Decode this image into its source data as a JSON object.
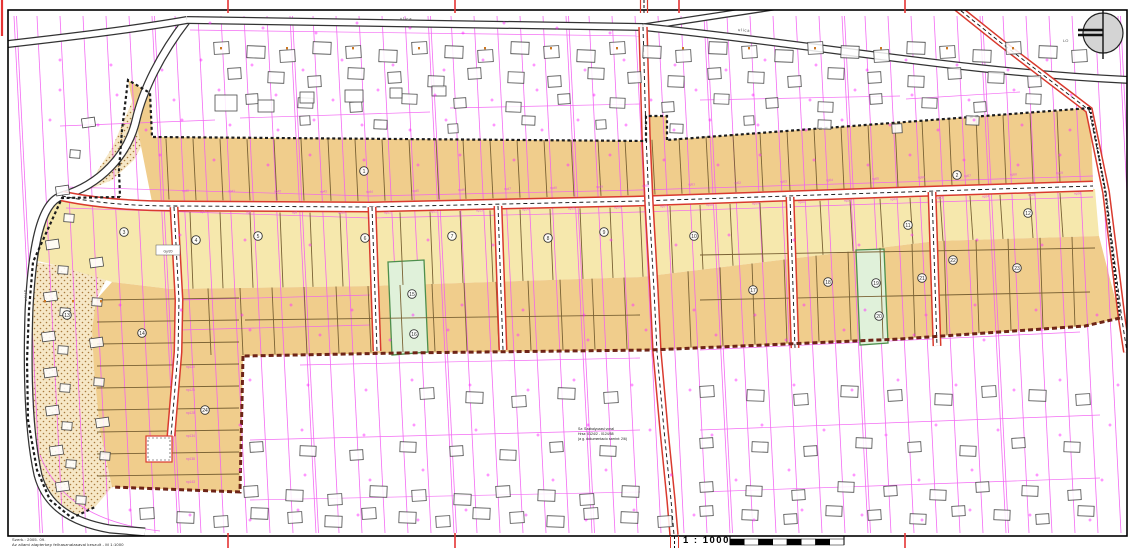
{
  "footer": {
    "scale_label": "1 : 1000",
    "left_line1": "Szerk.: 2005. 09.",
    "left_line2": "Az allami alapterkep felhasznalasaval keszult - M 1:1000"
  },
  "annotation": {
    "lines": [
      "Sz: Szabalyozasi vonal",
      "Hrsz: 0124/2 - 0124/58",
      "(a g. dokumentacio szerint: 2/6)"
    ]
  },
  "colors": {
    "magenta": "#f25cf2",
    "magenta2": "#ff2fff",
    "tan": "#f0cd8c",
    "light": "#f6e8ad",
    "stipple_bg": "#f6e7c6",
    "stipple_dot": "#a97b3e",
    "green_fill": "#e0f1da",
    "green_stroke": "#4d8f4d",
    "road_red": "#d93a2e",
    "road_black": "#333333",
    "maroon": "#6e2417",
    "boundary": "#1c1c1c",
    "divider": "#7a6234",
    "building": "#4a4a4a",
    "marker": "#333333",
    "np": "#e34fe3",
    "orange": "#cc7722",
    "tick_red": "#e53333",
    "text": "#222222"
  },
  "canvas": {
    "w": 1129,
    "h": 548
  },
  "frame": {
    "x": 8,
    "y": 10,
    "w": 1119,
    "h": 526
  },
  "red_ticks": {
    "top": [
      228,
      455,
      679,
      905
    ],
    "bottom": [
      228,
      455,
      905
    ],
    "left_edge_x": 2
  },
  "compass": {
    "cx": 1103,
    "cy": 33,
    "r": 20,
    "label": "LO"
  },
  "scalebar": {
    "x": 730,
    "y": 539,
    "w": 114,
    "h": 6,
    "segments": 8
  },
  "zones": {
    "upper_tan": [
      [
        128,
        80
      ],
      [
        150,
        93
      ],
      [
        152,
        137
      ],
      [
        646,
        141
      ],
      [
        646,
        116
      ],
      [
        667,
        116
      ],
      [
        667,
        140
      ],
      [
        1090,
        108
      ],
      [
        1093,
        182
      ],
      [
        935,
        188
      ],
      [
        640,
        198
      ],
      [
        370,
        204
      ],
      [
        152,
        202
      ]
    ],
    "light_strip": [
      [
        62,
        198
      ],
      [
        175,
        211
      ],
      [
        370,
        212
      ],
      [
        640,
        206
      ],
      [
        935,
        196
      ],
      [
        1095,
        189
      ],
      [
        1099,
        236
      ],
      [
        936,
        241
      ],
      [
        641,
        277
      ],
      [
        371,
        286
      ],
      [
        171,
        289
      ],
      [
        112,
        282
      ],
      [
        60,
        266
      ],
      [
        33,
        260
      ],
      [
        37,
        232
      ],
      [
        48,
        208
      ]
    ],
    "tan_lower": [
      [
        112,
        282
      ],
      [
        171,
        289
      ],
      [
        371,
        286
      ],
      [
        641,
        277
      ],
      [
        936,
        241
      ],
      [
        1099,
        236
      ],
      [
        1120,
        318
      ],
      [
        1085,
        326
      ],
      [
        900,
        339
      ],
      [
        650,
        350
      ],
      [
        400,
        353
      ],
      [
        243,
        356
      ],
      [
        240,
        492
      ],
      [
        112,
        487
      ],
      [
        100,
        430
      ],
      [
        94,
        370
      ],
      [
        92,
        330
      ],
      [
        96,
        300
      ]
    ],
    "stipple_upper": [
      [
        140,
        90
      ],
      [
        150,
        97
      ],
      [
        150,
        130
      ],
      [
        134,
        160
      ],
      [
        112,
        180
      ],
      [
        88,
        190
      ],
      [
        98,
        170
      ],
      [
        112,
        148
      ],
      [
        124,
        120
      ],
      [
        132,
        102
      ]
    ],
    "stipple_lower": [
      [
        33,
        262
      ],
      [
        110,
        272
      ],
      [
        96,
        300
      ],
      [
        92,
        330
      ],
      [
        94,
        370
      ],
      [
        100,
        430
      ],
      [
        112,
        487
      ],
      [
        95,
        507
      ],
      [
        70,
        518
      ],
      [
        50,
        500
      ],
      [
        37,
        470
      ],
      [
        28,
        420
      ],
      [
        27,
        360
      ],
      [
        29,
        310
      ]
    ],
    "green1": [
      [
        388,
        262
      ],
      [
        424,
        260
      ],
      [
        428,
        352
      ],
      [
        392,
        355
      ]
    ],
    "green2": [
      [
        856,
        250
      ],
      [
        884,
        249
      ],
      [
        888,
        343
      ],
      [
        860,
        345
      ]
    ]
  },
  "edges": {
    "tb": [
      [
        152,
        139
      ],
      [
        646,
        140
      ],
      [
        667,
        139
      ],
      [
        1090,
        109
      ]
    ],
    "road_top": [
      [
        62,
        191
      ],
      [
        175,
        200
      ],
      [
        370,
        201
      ],
      [
        640,
        195
      ],
      [
        935,
        186
      ],
      [
        1093,
        181
      ]
    ],
    "road_bot": [
      [
        62,
        203
      ],
      [
        175,
        212
      ],
      [
        370,
        213
      ],
      [
        640,
        207
      ],
      [
        935,
        197
      ],
      [
        1093,
        192
      ]
    ],
    "lb": [
      [
        171,
        289
      ],
      [
        371,
        286
      ],
      [
        641,
        277
      ],
      [
        936,
        241
      ],
      [
        1099,
        236
      ]
    ],
    "bb": [
      [
        243,
        355
      ],
      [
        400,
        352
      ],
      [
        650,
        349
      ],
      [
        900,
        338
      ],
      [
        1085,
        326
      ]
    ]
  },
  "boundaries": {
    "black_dashed": [
      [
        [
          1090,
          108
        ],
        [
          667,
          140
        ]
      ],
      [
        [
          667,
          140
        ],
        [
          667,
          116
        ],
        [
          646,
          116
        ],
        [
          646,
          141
        ],
        [
          152,
          137
        ],
        [
          150,
          93
        ],
        [
          128,
          80
        ],
        [
          122,
          130
        ],
        [
          119,
          170
        ],
        [
          120,
          197
        ]
      ],
      [
        [
          120,
          197
        ],
        [
          62,
          198
        ],
        [
          33,
          262
        ],
        [
          29,
          310
        ],
        [
          27,
          360
        ],
        [
          28,
          420
        ],
        [
          37,
          470
        ],
        [
          50,
          500
        ],
        [
          72,
          518
        ],
        [
          95,
          507
        ]
      ]
    ],
    "black_dotted_right": [
      [
        1090,
        108
      ],
      [
        1105,
        190
      ],
      [
        1120,
        318
      ]
    ],
    "maroon": [
      [
        [
          1120,
          318
        ],
        [
          1085,
          326
        ],
        [
          900,
          339
        ],
        [
          650,
          350
        ],
        [
          400,
          353
        ],
        [
          243,
          356
        ]
      ],
      [
        [
          243,
          356
        ],
        [
          240,
          492
        ],
        [
          112,
          487
        ]
      ]
    ]
  },
  "roads": [
    {
      "name": "left-street",
      "d": "M 187,20 C 160,55 143,90 136,120 C 128,155 100,185 62,196 C 40,202 32,250 29,310 C 27,370 28,430 38,475 C 46,505 70,522 110,529 L 145,532",
      "style": "black",
      "ew": 9,
      "fw": 6.5
    },
    {
      "name": "top-road-west",
      "d": "M 8,44 C 60,38 130,30 187,20",
      "style": "black",
      "ew": 8,
      "fw": 5.5
    },
    {
      "name": "top-road-mid",
      "d": "M 187,20 L 643,27",
      "style": "black",
      "ew": 8,
      "fw": 5.5
    },
    {
      "name": "top-road-ne",
      "d": "M 643,27 L 800,3",
      "style": "black",
      "ew": 7,
      "fw": 4.5
    },
    {
      "name": "top-road-east",
      "d": "M 643,27 C 820,45 960,72 1129,80",
      "style": "black",
      "ew": 8,
      "fw": 5.5
    },
    {
      "name": "main-road",
      "d": "M 62,196 C 100,204 140,206 175,206 L 370,207 L 640,201 L 935,191 L 1093,186",
      "style": "red",
      "ew": 11,
      "fw": 8
    },
    {
      "name": "north-south-road",
      "d": "M 643,27 L 646,135 L 649,203 L 654,290 L 657,352 L 664,430 L 671,500 L 674,535",
      "style": "red",
      "ew": 9.5,
      "fw": 6.5
    },
    {
      "name": "branch-1",
      "d": "M 174,207 L 179,300 L 178,352 L 171,436",
      "style": "red",
      "ew": 9,
      "fw": 6
    },
    {
      "name": "branch-2",
      "d": "M 372,207 L 377,351",
      "style": "red",
      "ew": 9,
      "fw": 6
    },
    {
      "name": "branch-3",
      "d": "M 498,206 L 503,350",
      "style": "red",
      "ew": 9,
      "fw": 6
    },
    {
      "name": "branch-4",
      "d": "M 790,197 L 795,348",
      "style": "red",
      "ew": 9,
      "fw": 6
    },
    {
      "name": "branch-5",
      "d": "M 932,192 L 937,346",
      "style": "red",
      "ew": 9,
      "fw": 6
    },
    {
      "name": "diagonal-road-ne",
      "d": "M 950,2 L 1000,42 L 1089,110 L 1106,192 L 1122,320 L 1127,352",
      "style": "red",
      "ew": 8,
      "fw": 5
    }
  ],
  "culdesac": {
    "x": 146,
    "y": 436,
    "w": 26,
    "h": 26
  },
  "strips": {
    "x0": 14,
    "step": 23,
    "count": 49,
    "y_top": 16,
    "y_bot": 533,
    "lean": 26
  },
  "h_lines": [
    [
      60,
      126,
      215,
      120
    ],
    [
      240,
      118,
      430,
      112
    ],
    [
      450,
      108,
      640,
      104
    ],
    [
      700,
      100,
      900,
      96
    ],
    [
      906,
      99,
      1020,
      92
    ],
    [
      300,
      365,
      640,
      358
    ],
    [
      700,
      350,
      1080,
      332
    ],
    [
      250,
      440,
      640,
      430
    ],
    [
      700,
      430,
      1100,
      415
    ],
    [
      250,
      500,
      640,
      492
    ],
    [
      700,
      492,
      1100,
      478
    ],
    [
      180,
      300,
      370,
      295
    ],
    [
      180,
      330,
      370,
      325
    ]
  ],
  "road_parallel": [
    [
      [
        66,
        187
      ],
      [
        370,
        196
      ],
      [
        640,
        190
      ],
      [
        935,
        181
      ],
      [
        1093,
        176
      ]
    ],
    [
      [
        66,
        208
      ],
      [
        370,
        218
      ],
      [
        640,
        212
      ],
      [
        935,
        202
      ],
      [
        1093,
        197
      ]
    ],
    [
      [
        190,
        30
      ],
      [
        640,
        36
      ]
    ]
  ],
  "bl_curve": "M 40,455 C 58,502 100,524 160,531",
  "divider_bands": [
    {
      "x0": 166,
      "step": 27,
      "count": 34,
      "top": "tb",
      "bot": "road_top"
    },
    {
      "x0": 190,
      "step": 30,
      "count": 30,
      "top": "road_bot",
      "bot": "lb"
    },
    {
      "x0": 208,
      "step": 32,
      "count": 28,
      "top": "lb",
      "bot": "bb"
    }
  ],
  "ext_h": {
    "y0": 300,
    "step": 22,
    "count": 9,
    "x0": 97,
    "x1": 239
  },
  "lower_h": [
    [
      700,
      255,
      1095,
      248
    ],
    [
      700,
      300,
      1090,
      292
    ],
    [
      245,
      320,
      640,
      315
    ]
  ],
  "buildings": {
    "rows": [
      {
        "y": 46,
        "x0": 214,
        "x1": 1078,
        "step": 33,
        "w": 15,
        "h": 12
      },
      {
        "y": 72,
        "x0": 228,
        "x1": 1066,
        "step": 40,
        "w": 13,
        "h": 11
      },
      {
        "y": 98,
        "x0": 246,
        "x1": 1050,
        "step": 52,
        "w": 12,
        "h": 10
      },
      {
        "y": 120,
        "x0": 300,
        "x1": 1000,
        "step": 74,
        "w": 10,
        "h": 9
      },
      {
        "y": 392,
        "x0": 420,
        "x1": 626,
        "step": 46,
        "w": 14,
        "h": 11
      },
      {
        "y": 390,
        "x0": 700,
        "x1": 1096,
        "step": 47,
        "w": 14,
        "h": 11
      },
      {
        "y": 446,
        "x0": 250,
        "x1": 626,
        "step": 50,
        "w": 13,
        "h": 10
      },
      {
        "y": 442,
        "x0": 700,
        "x1": 1104,
        "step": 52,
        "w": 13,
        "h": 10
      },
      {
        "y": 490,
        "x0": 244,
        "x1": 630,
        "step": 42,
        "w": 14,
        "h": 11
      },
      {
        "y": 486,
        "x0": 700,
        "x1": 1100,
        "step": 46,
        "w": 13,
        "h": 10
      },
      {
        "y": 512,
        "x0": 140,
        "x1": 660,
        "step": 37,
        "w": 14,
        "h": 11
      },
      {
        "y": 510,
        "x0": 700,
        "x1": 1094,
        "step": 42,
        "w": 13,
        "h": 10
      }
    ],
    "stipple": [
      [
        82,
        118
      ],
      [
        70,
        150
      ],
      [
        56,
        186
      ],
      [
        64,
        214
      ],
      [
        46,
        240
      ],
      [
        58,
        266
      ],
      [
        44,
        292
      ],
      [
        60,
        308
      ],
      [
        42,
        332
      ],
      [
        58,
        346
      ],
      [
        44,
        368
      ],
      [
        60,
        384
      ],
      [
        46,
        406
      ],
      [
        62,
        422
      ],
      [
        50,
        446
      ],
      [
        66,
        460
      ],
      [
        56,
        482
      ],
      [
        76,
        496
      ],
      [
        90,
        258
      ],
      [
        92,
        298
      ],
      [
        90,
        338
      ],
      [
        94,
        378
      ],
      [
        96,
        418
      ],
      [
        100,
        452
      ]
    ],
    "topleft": [
      [
        215,
        95,
        22,
        16
      ],
      [
        258,
        100,
        16,
        12
      ],
      [
        300,
        92,
        14,
        11
      ],
      [
        345,
        90,
        18,
        12
      ],
      [
        390,
        88,
        12,
        10
      ],
      [
        432,
        86,
        14,
        10
      ]
    ]
  },
  "scatter_rows": [
    {
      "y": 28,
      "x0": 210,
      "x1": 630,
      "step": 49
    },
    {
      "y": 65,
      "x0": 60,
      "x1": 1080,
      "step": 47
    },
    {
      "y": 95,
      "x0": 60,
      "x1": 1080,
      "step": 53
    },
    {
      "y": 125,
      "x0": 50,
      "x1": 1080,
      "step": 44
    },
    {
      "y": 160,
      "x0": 160,
      "x1": 1080,
      "step": 50
    },
    {
      "y": 240,
      "x0": 180,
      "x1": 1090,
      "step": 61
    },
    {
      "y": 310,
      "x0": 120,
      "x1": 1090,
      "step": 57
    },
    {
      "y": 335,
      "x0": 250,
      "x1": 1080,
      "step": 66
    },
    {
      "y": 385,
      "x0": 250,
      "x1": 1120,
      "step": 54
    },
    {
      "y": 430,
      "x0": 240,
      "x1": 1120,
      "step": 58
    },
    {
      "y": 475,
      "x0": 240,
      "x1": 1120,
      "step": 61
    },
    {
      "y": 515,
      "x0": 130,
      "x1": 1120,
      "step": 56
    }
  ],
  "orange_rows": [
    {
      "y": 47,
      "x0": 220,
      "x1": 1070,
      "step": 66
    },
    {
      "y": 300,
      "x0": 44,
      "x1": 100,
      "step": 28
    }
  ],
  "np": {
    "row_top": {
      "prefix": "np",
      "start": 40,
      "count": 20,
      "x0": 182,
      "step": 46,
      "dy": -8
    },
    "row_bottom": {
      "prefix": "np",
      "start": 7,
      "count": 20,
      "x0": 200,
      "step": 46,
      "dy": 13
    },
    "ext": {
      "labels": [
        "np120",
        "np125",
        "np128",
        "np134",
        "np138",
        "np143"
      ],
      "x": 186,
      "y0": 368,
      "step": 23
    }
  },
  "gy_box": {
    "x": 156,
    "y": 245,
    "w": 24,
    "h": 10,
    "text": "Gy/20"
  },
  "street_labels": [
    {
      "text": "ulica",
      "x": 400,
      "y": 20,
      "rot": 1
    },
    {
      "text": "ulica",
      "x": 738,
      "y": 31,
      "rot": 5
    },
    {
      "text": "ulica",
      "x": 24,
      "y": 290,
      "rot": 85
    }
  ],
  "markers": [
    {
      "n": "1",
      "x": 364,
      "y": 171
    },
    {
      "n": "2",
      "x": 957,
      "y": 175
    },
    {
      "n": "3",
      "x": 124,
      "y": 232
    },
    {
      "n": "4",
      "x": 196,
      "y": 240
    },
    {
      "n": "5",
      "x": 258,
      "y": 236
    },
    {
      "n": "6",
      "x": 365,
      "y": 238
    },
    {
      "n": "7",
      "x": 452,
      "y": 236
    },
    {
      "n": "8",
      "x": 548,
      "y": 238
    },
    {
      "n": "9",
      "x": 604,
      "y": 232
    },
    {
      "n": "10",
      "x": 694,
      "y": 236
    },
    {
      "n": "11",
      "x": 908,
      "y": 225
    },
    {
      "n": "12",
      "x": 1028,
      "y": 213
    },
    {
      "n": "13",
      "x": 67,
      "y": 315
    },
    {
      "n": "14",
      "x": 142,
      "y": 333
    },
    {
      "n": "15",
      "x": 412,
      "y": 294
    },
    {
      "n": "16",
      "x": 414,
      "y": 334
    },
    {
      "n": "17",
      "x": 753,
      "y": 290
    },
    {
      "n": "18",
      "x": 828,
      "y": 282
    },
    {
      "n": "19",
      "x": 876,
      "y": 283
    },
    {
      "n": "20",
      "x": 879,
      "y": 316
    },
    {
      "n": "21",
      "x": 922,
      "y": 278
    },
    {
      "n": "22",
      "x": 953,
      "y": 260
    },
    {
      "n": "23",
      "x": 1017,
      "y": 268
    },
    {
      "n": "24",
      "x": 205,
      "y": 410
    }
  ]
}
